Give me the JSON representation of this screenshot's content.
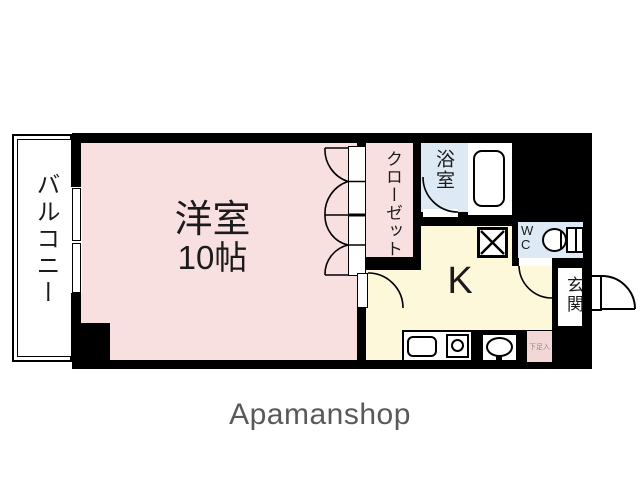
{
  "floorplan": {
    "balcony_label": "バルコニー",
    "room_label": "洋室",
    "room_size": "10帖",
    "closet_label": "クローゼット",
    "bath_label": "浴室",
    "kitchen_label": "K",
    "wc_label_w": "W",
    "wc_label_c": "C",
    "entrance_label": "玄関",
    "shoe_cupboard_label": "下足入",
    "watermark": "Apamanshop",
    "colors": {
      "wall_black": "#000000",
      "room_pink": "#f8e0e1",
      "kitchen_yellow": "#fcf8d9",
      "wet_area_blue": "#dde9f4",
      "shoe_cupboard_pink": "#f3d7d7",
      "watermark_grey": "#58595b"
    }
  }
}
